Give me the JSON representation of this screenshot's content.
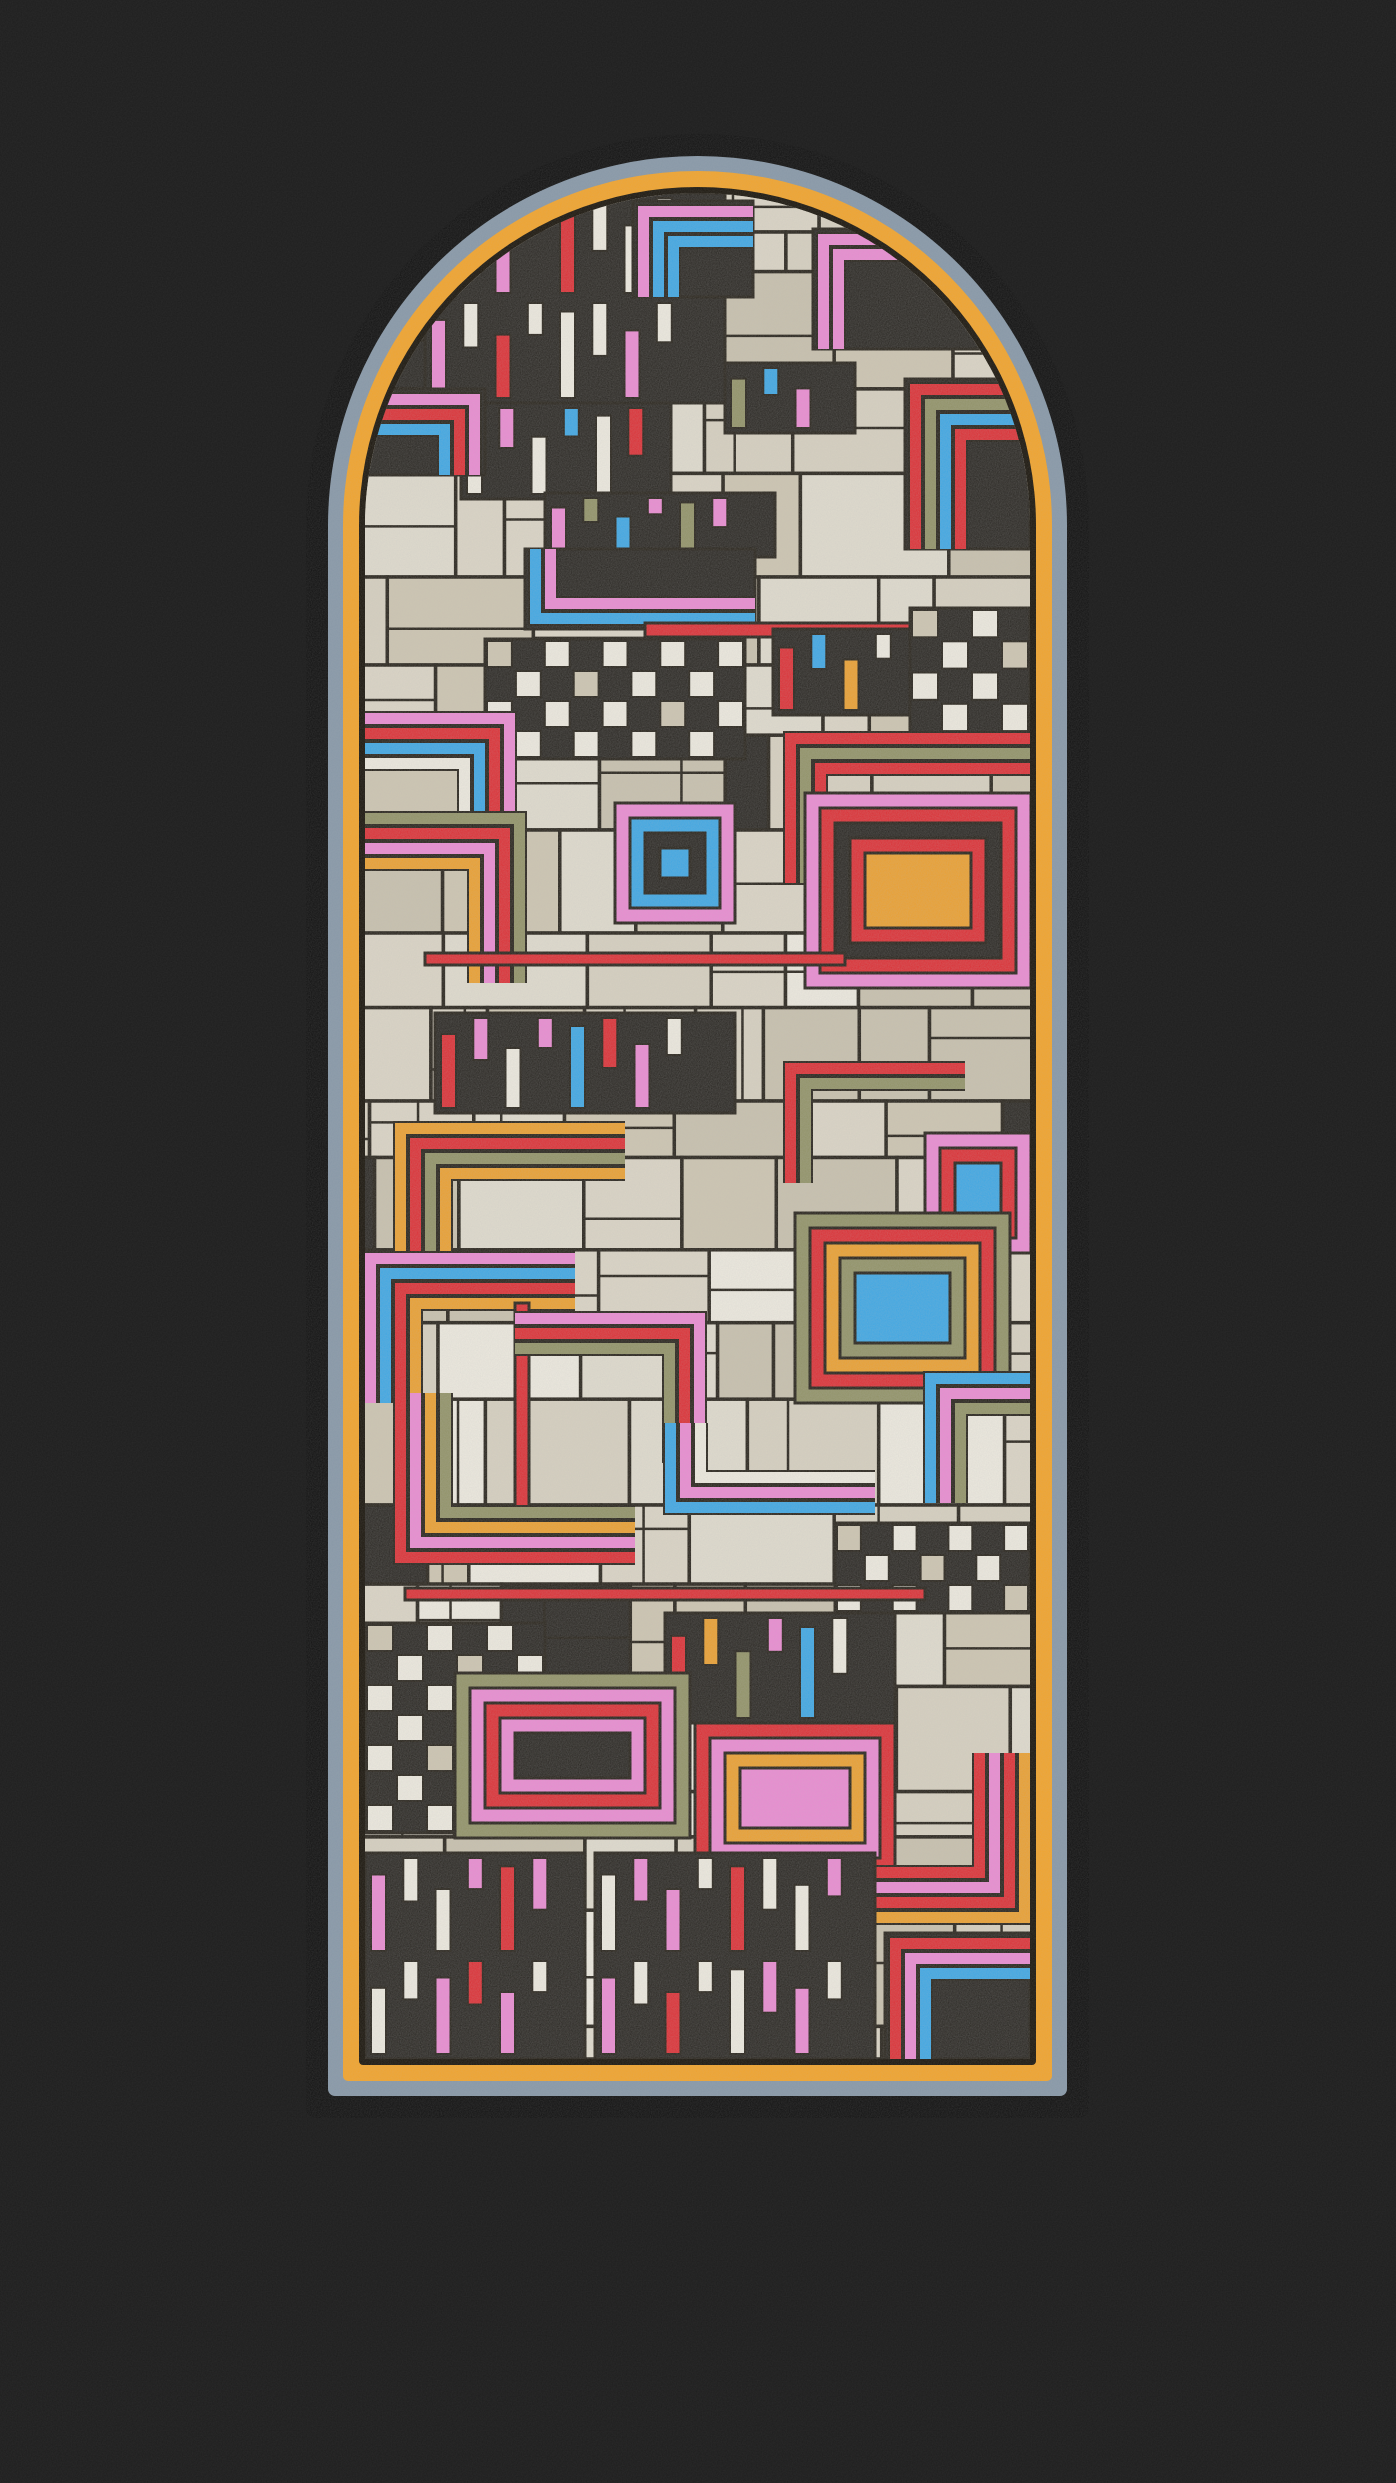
{
  "artwork": {
    "kind": "stained-glass-arch-window",
    "canvas": {
      "width": 1396,
      "height": 2483,
      "background": "#1e1e1e"
    },
    "window": {
      "x": 306,
      "y": 134,
      "width": 783,
      "height": 1984,
      "arch_radius": 392,
      "rings": [
        {
          "name": "outer-black-frame",
          "color": "#0c0c0c",
          "thickness": 22
        },
        {
          "name": "slate-blue-band",
          "color": "#8697a7",
          "thickness": 15
        },
        {
          "name": "amber-band",
          "color": "#f2a32a",
          "thickness": 16
        },
        {
          "name": "lead-line",
          "color": "#171209",
          "thickness": 6
        }
      ],
      "glass": {
        "width": 665,
        "height": 1866,
        "base_color": "#d9d2c0"
      }
    },
    "palette": {
      "lead": "#171209",
      "red": "#e02127",
      "pink": "#ef86d4",
      "blue": "#31a5e9",
      "orange": "#f09d22",
      "olive": "#8d8e5e",
      "white": "#f2eee2",
      "black": "#1b1813"
    },
    "beige_tones": [
      "#d9d2c0",
      "#cfc6b0",
      "#e3decf",
      "#c9c1ac",
      "#ded7c6"
    ],
    "base_patchwork": {
      "seed": 7,
      "row_min": 38,
      "row_max": 120,
      "col_min": 40,
      "col_max": 150,
      "p_white": 0.07,
      "p_black": 0.07,
      "outline_width": 3.5
    },
    "motifs": [
      {
        "t": "keys",
        "x": 60,
        "y": 0,
        "w": 300,
        "h": 210,
        "rows": 2,
        "colors": [
          "white",
          "white",
          "pink",
          "white",
          "red",
          "white"
        ]
      },
      {
        "t": "corner",
        "x": 268,
        "y": 8,
        "w": 120,
        "h": 96,
        "dir": "tl",
        "bg": "black",
        "colors": [
          "pink",
          "blue",
          "blue"
        ]
      },
      {
        "t": "corner",
        "x": 448,
        "y": 36,
        "w": 168,
        "h": 120,
        "dir": "tl",
        "bg": "black",
        "colors": [
          "pink",
          "pink"
        ]
      },
      {
        "t": "keys",
        "x": 96,
        "y": 210,
        "w": 210,
        "h": 96,
        "rows": 1,
        "colors": [
          "white",
          "pink",
          "white",
          "blue",
          "white",
          "red"
        ]
      },
      {
        "t": "corner",
        "x": 0,
        "y": 196,
        "w": 120,
        "h": 86,
        "dir": "tr",
        "bg": "black",
        "colors": [
          "pink",
          "red",
          "blue"
        ]
      },
      {
        "t": "corner",
        "x": 540,
        "y": 186,
        "w": 125,
        "h": 170,
        "dir": "tl",
        "bg": "black",
        "colors": [
          "red",
          "olive",
          "blue",
          "red"
        ]
      },
      {
        "t": "keys",
        "x": 360,
        "y": 170,
        "w": 130,
        "h": 70,
        "rows": 1,
        "colors": [
          "olive",
          "blue",
          "pink",
          "white"
        ]
      },
      {
        "t": "keys",
        "x": 180,
        "y": 300,
        "w": 230,
        "h": 64,
        "rows": 1,
        "colors": [
          "pink",
          "olive",
          "blue",
          "pink",
          "olive"
        ]
      },
      {
        "t": "corner",
        "x": 160,
        "y": 356,
        "w": 230,
        "h": 80,
        "dir": "bl",
        "bg": "black",
        "colors": [
          "blue",
          "pink"
        ]
      },
      {
        "t": "checker",
        "x": 120,
        "y": 446,
        "w": 260,
        "h": 120
      },
      {
        "t": "band",
        "x": 280,
        "y": 430,
        "w": 280,
        "h": 14,
        "colors": [
          "red"
        ]
      },
      {
        "t": "keys",
        "x": 408,
        "y": 436,
        "w": 150,
        "h": 86,
        "rows": 1,
        "colors": [
          "red",
          "blue",
          "orange",
          "white"
        ]
      },
      {
        "t": "checker",
        "x": 545,
        "y": 415,
        "w": 120,
        "h": 125
      },
      {
        "t": "corner",
        "x": 420,
        "y": 540,
        "w": 245,
        "h": 150,
        "dir": "tl",
        "colors": [
          "red",
          "olive",
          "red"
        ]
      },
      {
        "t": "corner",
        "x": 0,
        "y": 520,
        "w": 150,
        "h": 110,
        "dir": "tr",
        "colors": [
          "pink",
          "red",
          "blue",
          "white"
        ]
      },
      {
        "t": "nest",
        "x": 250,
        "y": 610,
        "w": 120,
        "h": 120,
        "colors": [
          "pink",
          "blue",
          "black",
          "blue"
        ]
      },
      {
        "t": "corner",
        "x": 0,
        "y": 620,
        "w": 160,
        "h": 170,
        "dir": "tr",
        "colors": [
          "olive",
          "red",
          "pink",
          "orange"
        ]
      },
      {
        "t": "nest",
        "x": 440,
        "y": 600,
        "w": 226,
        "h": 195,
        "colors": [
          "pink",
          "red",
          "black",
          "red",
          "orange"
        ]
      },
      {
        "t": "band",
        "x": 60,
        "y": 760,
        "w": 420,
        "h": 12,
        "colors": [
          "red"
        ]
      },
      {
        "t": "keys",
        "x": 70,
        "y": 820,
        "w": 300,
        "h": 100,
        "rows": 1,
        "colors": [
          "red",
          "pink",
          "white",
          "pink",
          "blue"
        ]
      },
      {
        "t": "corner",
        "x": 420,
        "y": 870,
        "w": 180,
        "h": 120,
        "dir": "tl",
        "colors": [
          "red",
          "olive"
        ]
      },
      {
        "t": "nest",
        "x": 560,
        "y": 940,
        "w": 106,
        "h": 120,
        "colors": [
          "pink",
          "red",
          "blue"
        ]
      },
      {
        "t": "corner",
        "x": 30,
        "y": 930,
        "w": 230,
        "h": 150,
        "dir": "tl",
        "colors": [
          "orange",
          "red",
          "olive",
          "orange"
        ]
      },
      {
        "t": "nest",
        "x": 430,
        "y": 1020,
        "w": 215,
        "h": 190,
        "colors": [
          "olive",
          "red",
          "orange",
          "olive",
          "blue"
        ]
      },
      {
        "t": "corner",
        "x": 0,
        "y": 1060,
        "w": 210,
        "h": 150,
        "dir": "tl",
        "colors": [
          "pink",
          "blue",
          "red",
          "orange"
        ]
      },
      {
        "t": "band",
        "x": 150,
        "y": 1110,
        "w": 14,
        "h": 240,
        "colors": [
          "red"
        ]
      },
      {
        "t": "corner",
        "x": 150,
        "y": 1120,
        "w": 190,
        "h": 150,
        "dir": "tr",
        "colors": [
          "pink",
          "red",
          "olive"
        ]
      },
      {
        "t": "corner",
        "x": 30,
        "y": 1200,
        "w": 240,
        "h": 170,
        "dir": "bl",
        "colors": [
          "red",
          "pink",
          "orange",
          "olive"
        ]
      },
      {
        "t": "corner",
        "x": 300,
        "y": 1230,
        "w": 210,
        "h": 90,
        "dir": "bl",
        "colors": [
          "blue",
          "pink",
          "white"
        ]
      },
      {
        "t": "corner",
        "x": 560,
        "y": 1180,
        "w": 105,
        "h": 130,
        "dir": "tl",
        "colors": [
          "blue",
          "pink",
          "olive"
        ]
      },
      {
        "t": "checker",
        "x": 470,
        "y": 1330,
        "w": 195,
        "h": 90
      },
      {
        "t": "band",
        "x": 40,
        "y": 1395,
        "w": 520,
        "h": 12,
        "colors": [
          "red"
        ]
      },
      {
        "t": "checker",
        "x": 0,
        "y": 1430,
        "w": 180,
        "h": 210
      },
      {
        "t": "keys",
        "x": 300,
        "y": 1420,
        "w": 230,
        "h": 110,
        "rows": 1,
        "colors": [
          "red",
          "orange",
          "olive",
          "pink",
          "blue",
          "white"
        ]
      },
      {
        "t": "nest",
        "x": 90,
        "y": 1480,
        "w": 235,
        "h": 165,
        "colors": [
          "olive",
          "pink",
          "red",
          "pink",
          "black"
        ]
      },
      {
        "t": "nest",
        "x": 330,
        "y": 1530,
        "w": 200,
        "h": 150,
        "colors": [
          "red",
          "pink",
          "orange",
          "pink"
        ]
      },
      {
        "t": "corner",
        "x": 430,
        "y": 1560,
        "w": 235,
        "h": 170,
        "dir": "br",
        "colors": [
          "orange",
          "red",
          "pink",
          "red"
        ]
      },
      {
        "t": "keys",
        "x": 0,
        "y": 1660,
        "w": 220,
        "h": 206,
        "rows": 2,
        "colors": [
          "pink",
          "white",
          "white",
          "pink",
          "red"
        ]
      },
      {
        "t": "keys",
        "x": 230,
        "y": 1660,
        "w": 280,
        "h": 206,
        "rows": 2,
        "colors": [
          "white",
          "pink",
          "pink",
          "white",
          "red",
          "white"
        ]
      },
      {
        "t": "corner",
        "x": 520,
        "y": 1740,
        "w": 145,
        "h": 126,
        "dir": "tl",
        "bg": "black",
        "colors": [
          "red",
          "pink",
          "blue"
        ]
      }
    ]
  }
}
